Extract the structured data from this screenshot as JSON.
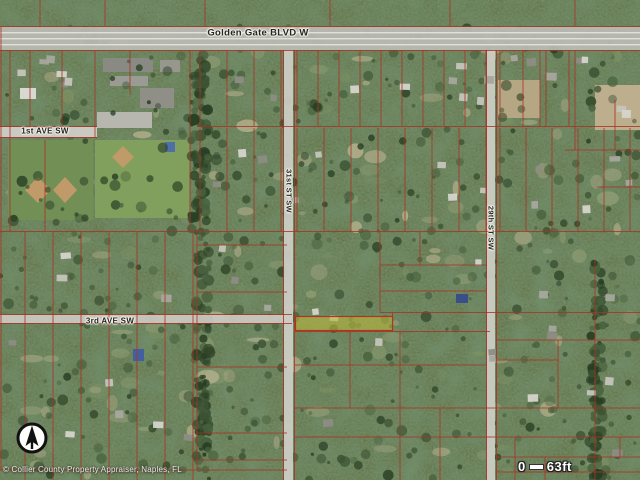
{
  "meta": {
    "width": 640,
    "height": 480,
    "description": "Aerial parcel map, Golden Gate Estates area"
  },
  "map": {
    "base_color": "#5c7547",
    "colors": {
      "parcel": "#b43120",
      "road": "#c6c5bd",
      "road_line": "#ebebe4",
      "highlight_fill": "#c3bd2a",
      "highlight_stroke": "#c03018",
      "canopy_dark": [
        "#2e4726",
        "#3a5530",
        "#46633a",
        "#263f20"
      ],
      "ground_light": [
        "#7d925e",
        "#97a475",
        "#b3ad85",
        "#c7bb92"
      ],
      "house": [
        "#a8a69d",
        "#c6c4bb",
        "#8e8c84",
        "#d6d4cb"
      ]
    },
    "roads": [
      {
        "name": "golden-gate-blvd-w",
        "x": 0,
        "y": 27,
        "w": 640,
        "h": 23,
        "fill": "#b9b9b1",
        "lanes": true
      },
      {
        "name": "1st-ave-sw",
        "x": 0,
        "y": 127,
        "w": 97,
        "h": 10,
        "fill": "#cfcec6",
        "lanes": false
      },
      {
        "name": "3rd-ave-sw",
        "x": 0,
        "y": 315,
        "w": 292,
        "h": 8,
        "fill": "#c8c7bf",
        "lanes": false
      },
      {
        "name": "31st-st-sw",
        "x": 284,
        "y": 50,
        "w": 9,
        "h": 430,
        "fill": "#cccbc3",
        "lanes": false
      },
      {
        "name": "29th-st-sw",
        "x": 487,
        "y": 50,
        "w": 8,
        "h": 430,
        "fill": "#cccbc3",
        "lanes": false
      }
    ],
    "road_labels": [
      {
        "text": "Golden Gate BLVD W",
        "x": 258,
        "y": 33,
        "rot": 0,
        "size": 9.5
      },
      {
        "text": "1st AVE SW",
        "x": 45,
        "y": 131,
        "rot": 0,
        "size": 8
      },
      {
        "text": "3rd AVE SW",
        "x": 110,
        "y": 321,
        "rot": 0,
        "size": 8
      },
      {
        "text": "31st ST SW",
        "x": 289,
        "y": 191,
        "rot": 90,
        "size": 7.5
      },
      {
        "text": "29th ST SW",
        "x": 491,
        "y": 228,
        "rot": 90,
        "size": 7.5
      }
    ],
    "highlight_parcel": {
      "x": 295.5,
      "y": 316.5,
      "w": 97,
      "h": 14
    },
    "parcel_lines": {
      "h": [
        [
          26.5,
          0,
          640
        ],
        [
          50.5,
          0,
          640
        ],
        [
          126.5,
          0,
          97
        ],
        [
          137.5,
          0,
          97
        ],
        [
          126.5,
          197,
          640
        ],
        [
          150,
          565,
          640
        ],
        [
          187,
          597,
          640
        ],
        [
          231.5,
          0,
          640
        ],
        [
          245,
          197,
          287
        ],
        [
          265,
          380,
          487
        ],
        [
          291,
          380,
          487
        ],
        [
          292,
          197,
          287
        ],
        [
          312.5,
          380,
          640
        ],
        [
          314.5,
          0,
          292
        ],
        [
          323.5,
          0,
          292
        ],
        [
          331.5,
          295,
          490
        ],
        [
          340,
          497,
          640
        ],
        [
          360,
          497,
          558
        ],
        [
          367,
          197,
          287
        ],
        [
          365,
          295,
          487
        ],
        [
          408,
          295,
          640
        ],
        [
          433,
          197,
          287
        ],
        [
          437,
          295,
          640
        ],
        [
          457,
          497,
          640
        ],
        [
          460,
          197,
          287
        ],
        [
          470,
          0,
          287
        ],
        [
          472,
          497,
          640
        ]
      ],
      "v": [
        [
          1,
          27,
          470
        ],
        [
          30,
          50,
          126
        ],
        [
          62,
          50,
          126
        ],
        [
          95,
          50,
          137
        ],
        [
          10,
          50,
          231
        ],
        [
          45,
          140,
          231
        ],
        [
          130,
          50,
          95
        ],
        [
          190,
          50,
          231
        ],
        [
          197,
          231,
          470
        ],
        [
          283.5,
          50,
          480
        ],
        [
          294.5,
          50,
          480
        ],
        [
          486.5,
          50,
          480
        ],
        [
          496.5,
          50,
          480
        ],
        [
          392.5,
          312,
          332
        ],
        [
          380,
          232,
          312
        ],
        [
          420,
          232,
          265
        ],
        [
          350,
          332,
          408
        ],
        [
          400,
          332,
          480
        ],
        [
          440,
          408,
          480
        ],
        [
          558,
          340,
          408
        ],
        [
          595,
          260,
          480
        ],
        [
          575,
          50,
          150
        ],
        [
          615,
          100,
          150
        ],
        [
          540,
          50,
          126
        ],
        [
          515,
          437,
          480
        ],
        [
          545,
          457,
          480
        ],
        [
          620,
          437,
          457
        ],
        [
          40,
          0,
          26
        ],
        [
          105,
          0,
          26
        ],
        [
          205,
          0,
          26
        ],
        [
          330,
          0,
          26
        ],
        [
          450,
          0,
          26
        ],
        [
          575,
          0,
          26
        ]
      ],
      "v_blocks": [
        [
          200,
          284,
          27,
          50,
          126
        ],
        [
          297,
          486,
          21,
          50,
          126
        ],
        [
          500,
          572,
          23,
          50,
          126
        ],
        [
          200,
          284,
          27,
          128,
          231
        ],
        [
          297,
          486,
          27,
          128,
          231
        ],
        [
          500,
          638,
          26,
          128,
          231
        ],
        [
          25,
          196,
          28,
          232,
          480
        ]
      ]
    },
    "features": [
      {
        "t": "rect",
        "x": 8,
        "y": 140,
        "w": 85,
        "h": 80,
        "f": "#6f9150"
      },
      {
        "t": "rect",
        "x": 95,
        "y": 140,
        "w": 95,
        "h": 78,
        "f": "#7fa055"
      },
      {
        "t": "rect",
        "x": 97,
        "y": 112,
        "w": 55,
        "h": 16,
        "f": "#b7b6ae"
      },
      {
        "t": "rect",
        "x": 103,
        "y": 58,
        "w": 50,
        "h": 14,
        "f": "#8a8a84"
      },
      {
        "t": "rect",
        "x": 110,
        "y": 76,
        "w": 38,
        "h": 10,
        "f": "#9b9a92"
      },
      {
        "t": "rect",
        "x": 140,
        "y": 88,
        "w": 34,
        "h": 20,
        "f": "#8f8e86"
      },
      {
        "t": "rect",
        "x": 160,
        "y": 60,
        "w": 20,
        "h": 12,
        "f": "#97968e"
      },
      {
        "t": "rect",
        "x": 20,
        "y": 88,
        "w": 16,
        "h": 11,
        "f": "#d8d7cf"
      },
      {
        "t": "rect",
        "x": 595,
        "y": 85,
        "w": 45,
        "h": 45,
        "f": "#bfae8a"
      },
      {
        "t": "rect",
        "x": 498,
        "y": 80,
        "w": 42,
        "h": 38,
        "f": "#b8a77f"
      },
      {
        "t": "diamond",
        "x": 25,
        "y": 177,
        "w": 26,
        "h": 26,
        "f": "#c49a62"
      },
      {
        "t": "diamond",
        "x": 53,
        "y": 177,
        "w": 24,
        "h": 26,
        "f": "#c49a62"
      },
      {
        "t": "diamond",
        "x": 112,
        "y": 146,
        "w": 22,
        "h": 22,
        "f": "#c49a62"
      },
      {
        "t": "rect",
        "x": 165,
        "y": 142,
        "w": 10,
        "h": 10,
        "f": "#4a6fae"
      },
      {
        "t": "rect",
        "x": 133,
        "y": 349,
        "w": 11,
        "h": 12,
        "f": "#3f5fa8"
      },
      {
        "t": "rect",
        "x": 456,
        "y": 294,
        "w": 12,
        "h": 9,
        "f": "#35508f"
      }
    ],
    "tree_strips": [
      {
        "x": 190,
        "y": 50,
        "w": 18,
        "h": 182
      },
      {
        "x": 196,
        "y": 232,
        "w": 14,
        "h": 248
      },
      {
        "x": 590,
        "y": 255,
        "w": 13,
        "h": 225
      }
    ],
    "house_zones": [
      {
        "x": 5,
        "y": 55,
        "w": 85,
        "h": 62,
        "n": 6
      },
      {
        "x": 205,
        "y": 55,
        "w": 430,
        "h": 64,
        "n": 16
      },
      {
        "x": 205,
        "y": 142,
        "w": 430,
        "h": 78,
        "n": 13
      },
      {
        "x": 5,
        "y": 240,
        "w": 270,
        "h": 215,
        "n": 12
      },
      {
        "x": 300,
        "y": 238,
        "w": 330,
        "h": 222,
        "n": 15
      }
    ],
    "compass": {
      "cx": 32,
      "cy": 438,
      "r": 14
    },
    "scale_bar": {
      "start": "0",
      "end": "63ft"
    },
    "copyright": "© Collier County Property Appraiser, Naples, FL"
  }
}
